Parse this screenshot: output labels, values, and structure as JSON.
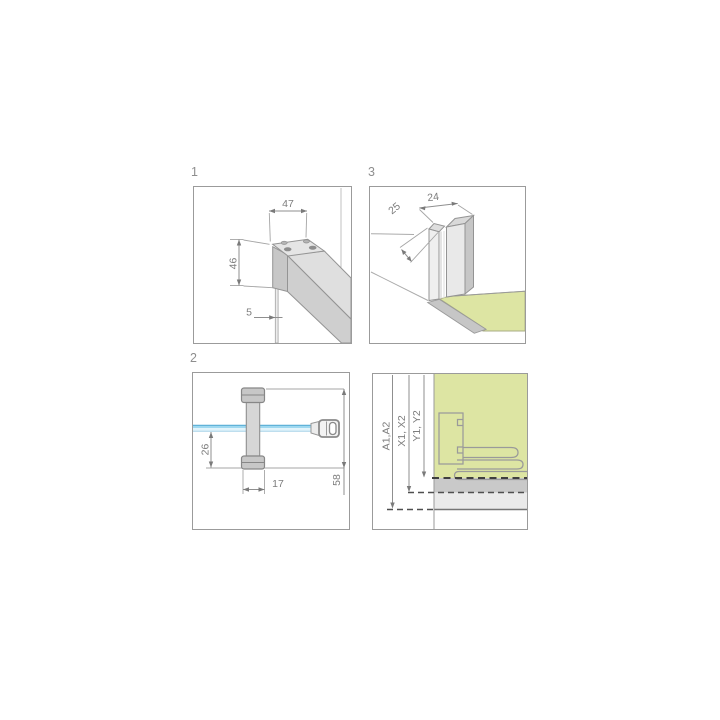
{
  "panels": {
    "bracket": {
      "number": "1",
      "dim_width": "47",
      "dim_height": "46",
      "dim_glass": "5"
    },
    "wall_profile": {
      "number": "3",
      "dim_depth": "25",
      "dim_width": "24"
    },
    "stabilizer": {
      "number": "2",
      "dim_drop": "26",
      "dim_holder_width": "17",
      "dim_holder_height": "58"
    },
    "installation": {
      "dim_a": "A1,A2",
      "dim_x": "X1, X2",
      "dim_y": "Y1, Y2"
    }
  },
  "colors": {
    "glass_green": "#dde5a3",
    "glass_blue": "#9ed8f0",
    "glass_blue_light": "#e0f3fb",
    "metal_light": "#dfdfdf",
    "metal_mid": "#cfcfcf",
    "metal_dark": "#c6c6c6",
    "dashed_bold": "#3f3f3f"
  }
}
